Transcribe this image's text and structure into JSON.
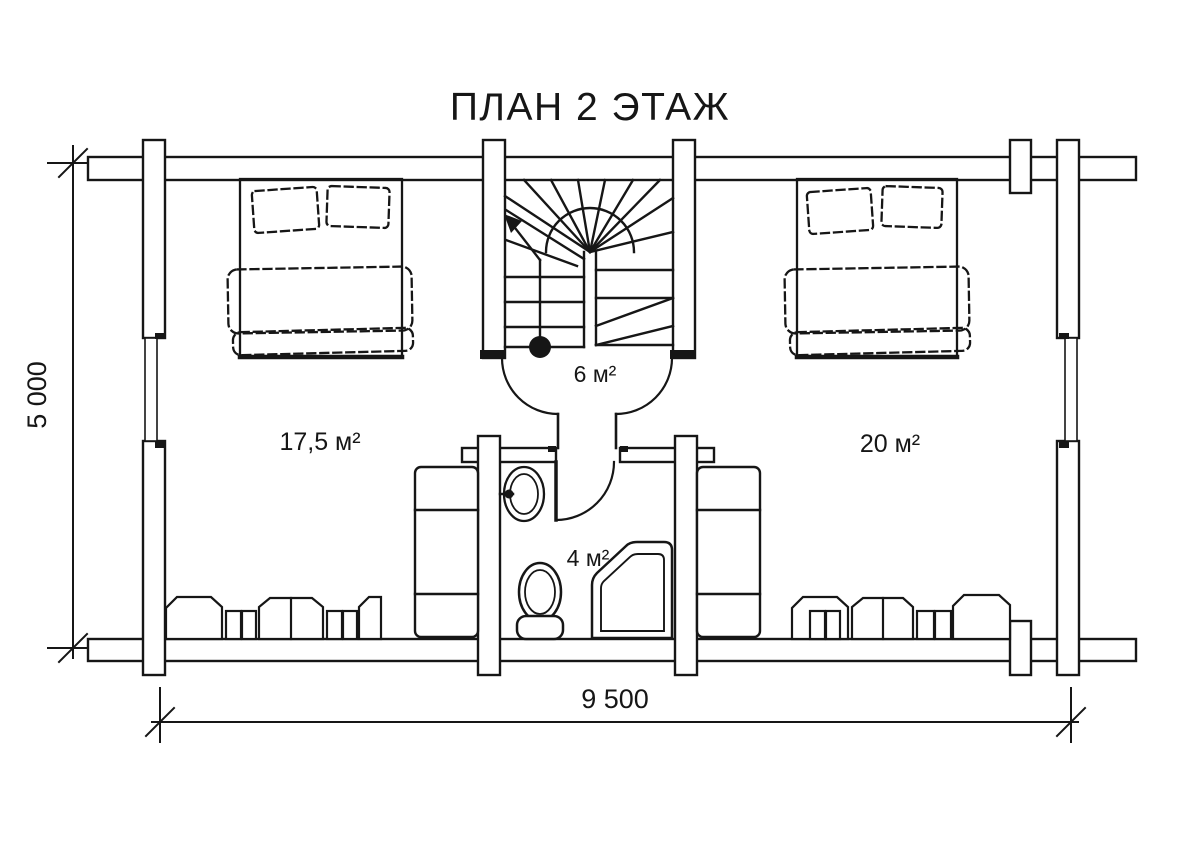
{
  "title": "ПЛАН 2 ЭТАЖ",
  "dimensions": {
    "horizontal": "9 500",
    "vertical": "5 000"
  },
  "rooms": {
    "bedroom_left": {
      "label": "17,5 м²"
    },
    "hall": {
      "label": "6 м²"
    },
    "bedroom_right": {
      "label": "20 м²"
    },
    "bathroom": {
      "label": "4 м²"
    }
  },
  "colors": {
    "line": "#161616",
    "background": "#ffffff"
  }
}
